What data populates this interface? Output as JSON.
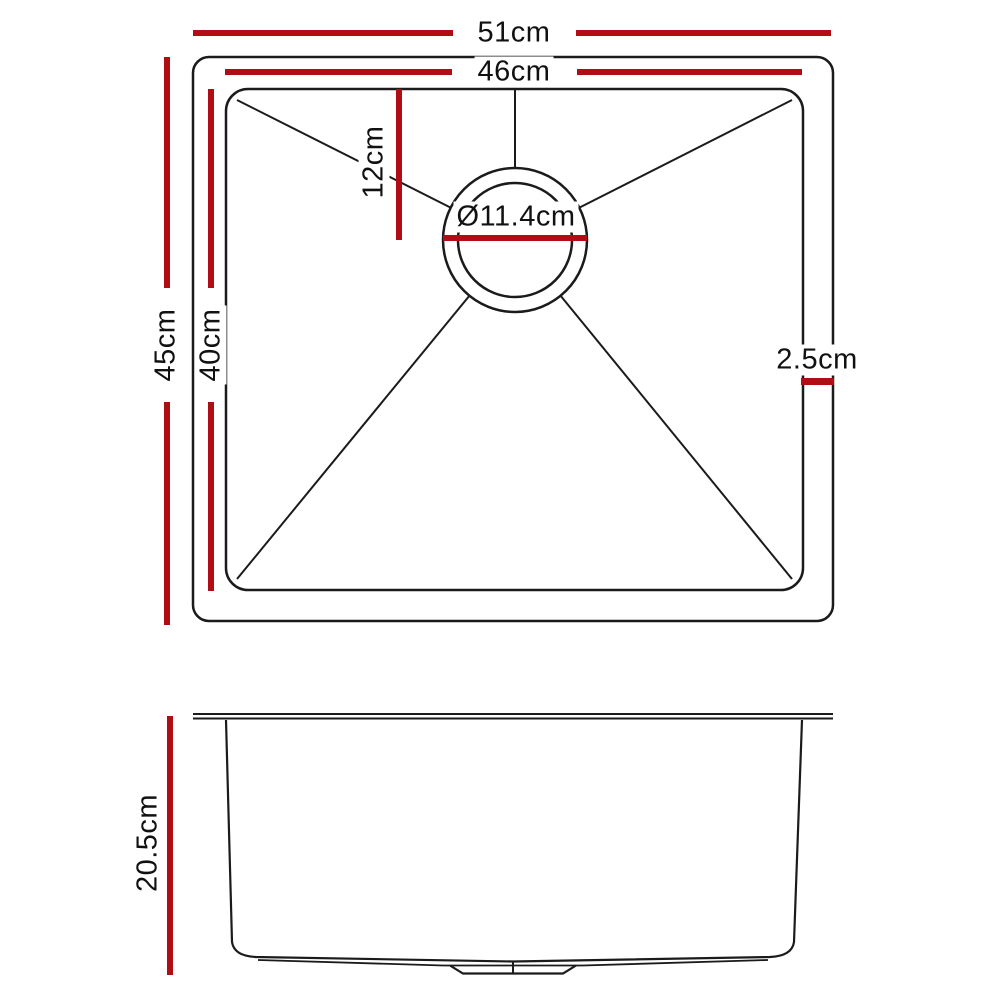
{
  "colors": {
    "dimension_line": "#b00e14",
    "outline": "#1b1b1b"
  },
  "top_view": {
    "dimensions": {
      "overall_width": "51cm",
      "inner_width": "46cm",
      "overall_depth": "45cm",
      "inner_depth": "40cm",
      "drain_offset": "12cm",
      "drain_diameter": "Ø11.4cm",
      "rim_width": "2.5cm"
    }
  },
  "side_view": {
    "dimensions": {
      "bowl_depth": "20.5cm"
    }
  }
}
